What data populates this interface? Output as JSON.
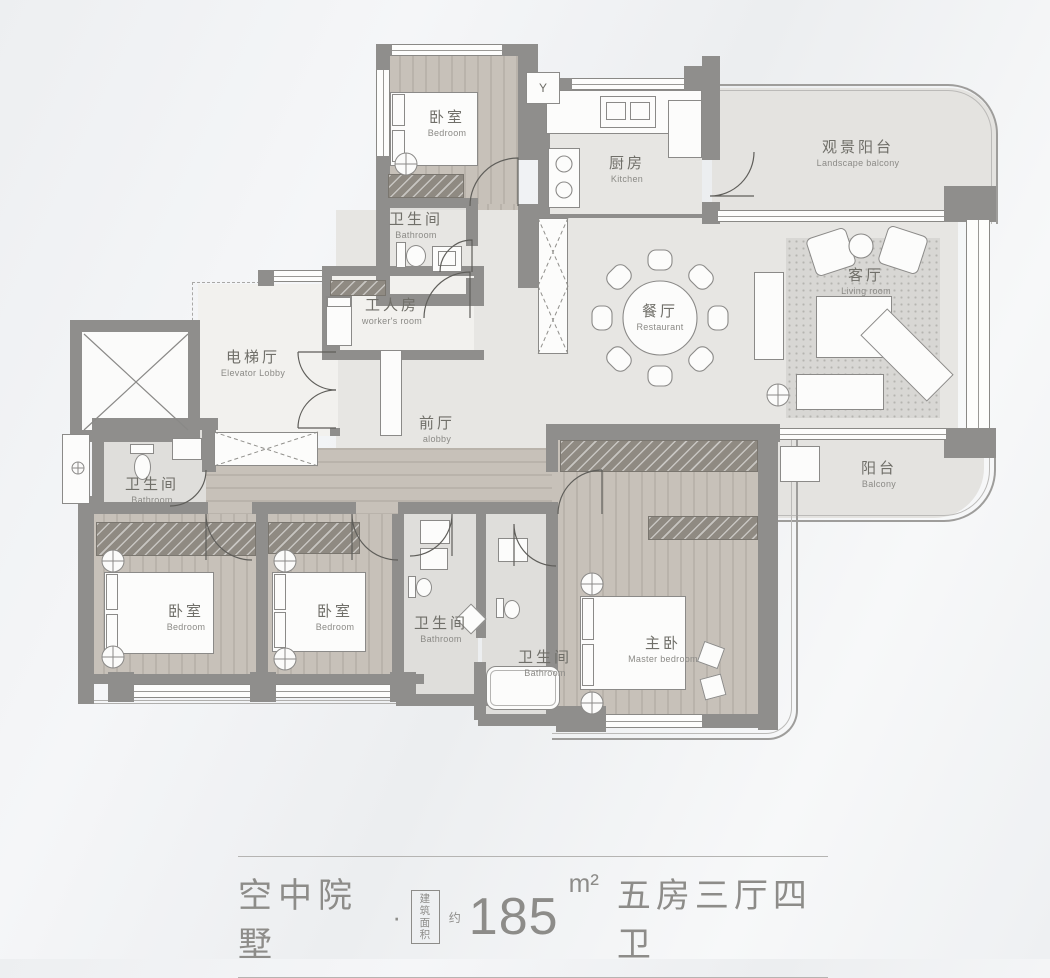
{
  "markers": {
    "flue": "Y"
  },
  "rooms": {
    "bedroom_top": {
      "zh": "卧室",
      "en": "Bedroom"
    },
    "bathroom_top": {
      "zh": "卫生间",
      "en": "Bathroom"
    },
    "kitchen": {
      "zh": "厨房",
      "en": "Kitchen"
    },
    "landscape_balcony": {
      "zh": "观景阳台",
      "en": "Landscape balcony"
    },
    "living_room": {
      "zh": "客厅",
      "en": "Living room"
    },
    "dining_room": {
      "zh": "餐厅",
      "en": "Restaurant"
    },
    "workers_room": {
      "zh": "工人房",
      "en": "worker's room"
    },
    "elevator_lobby": {
      "zh": "电梯厅",
      "en": "Elevator Lobby"
    },
    "front_hall": {
      "zh": "前厅",
      "en": "alobby"
    },
    "bathroom_left": {
      "zh": "卫生间",
      "en": "Bathroom"
    },
    "bedroom_left": {
      "zh": "卧室",
      "en": "Bedroom"
    },
    "bedroom_mid": {
      "zh": "卧室",
      "en": "Bedroom"
    },
    "bathroom_mid_1": {
      "zh": "卫生间",
      "en": "Bathroom"
    },
    "bathroom_mid_2": {
      "zh": "卫生间",
      "en": "Bathroom"
    },
    "master_bedroom": {
      "zh": "主卧",
      "en": "Master bedroom"
    },
    "balcony": {
      "zh": "阳台",
      "en": "Balcony"
    }
  },
  "caption": {
    "project": "空中院墅",
    "separator": "·",
    "area_label_top": "建筑",
    "area_label_bottom": "面积",
    "approx": "约",
    "area_value": "185",
    "area_unit": "m²",
    "layout": "五房三厅四卫"
  },
  "colors": {
    "wall": "#8f8e8c",
    "wood_floor": "#c0bab2",
    "stone_floor": "#e7e6e3",
    "label_text": "#706f69",
    "caption_text": "#8d8c89",
    "caption_line": "#b5b4b2"
  }
}
